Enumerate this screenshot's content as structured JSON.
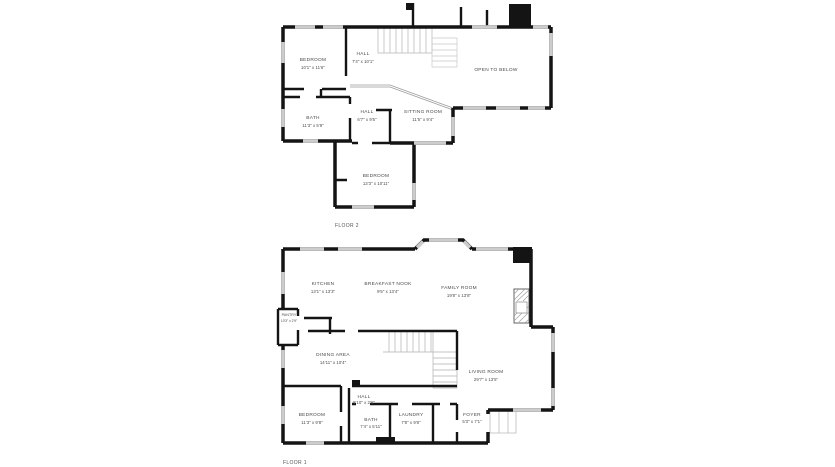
{
  "colors": {
    "wall": "#141414",
    "window": "#cccccc",
    "stair_line": "#b5b5b5",
    "label": "#4a4a4a",
    "background": "#ffffff"
  },
  "floors": [
    {
      "caption": "FLOOR 2",
      "rooms": [
        {
          "name": "BEDROOM",
          "dims": "10'1\" x 11'6\""
        },
        {
          "name": "HALL",
          "dims": "7'4\" x 10'1\""
        },
        {
          "name": "OPEN TO BELOW",
          "dims": ""
        },
        {
          "name": "BATH",
          "dims": "11'3\" x 5'9\""
        },
        {
          "name": "HALL",
          "dims": "6'7\" x 9'5\""
        },
        {
          "name": "SITTING ROOM",
          "dims": "11'5\" x 9'4\""
        },
        {
          "name": "BEDROOM",
          "dims": "13'3\" x 10'11\""
        }
      ]
    },
    {
      "caption": "FLOOR 1",
      "rooms": [
        {
          "name": "KITCHEN",
          "dims": "13'1\" x 13'3\""
        },
        {
          "name": "BREAKFAST NOOK",
          "dims": "9'5\" x 13'4\""
        },
        {
          "name": "FAMILY ROOM",
          "dims": "19'8\" x 13'8\""
        },
        {
          "name": "PANTRY",
          "dims": "10'3\" x 2'9\""
        },
        {
          "name": "DINING AREA",
          "dims": "14'11\" x 10'4\""
        },
        {
          "name": "LIVING ROOM",
          "dims": "29'7\" x 13'5\""
        },
        {
          "name": "HALL",
          "dims": "5'10\" x 2'6\""
        },
        {
          "name": "BEDROOM",
          "dims": "11'3\" x 9'8\""
        },
        {
          "name": "BATH",
          "dims": "7'4\" x 5'11\""
        },
        {
          "name": "LAUNDRY",
          "dims": "7'8\" x 9'8\""
        },
        {
          "name": "FOYER",
          "dims": "5'3\" x 7'1\""
        }
      ]
    }
  ]
}
